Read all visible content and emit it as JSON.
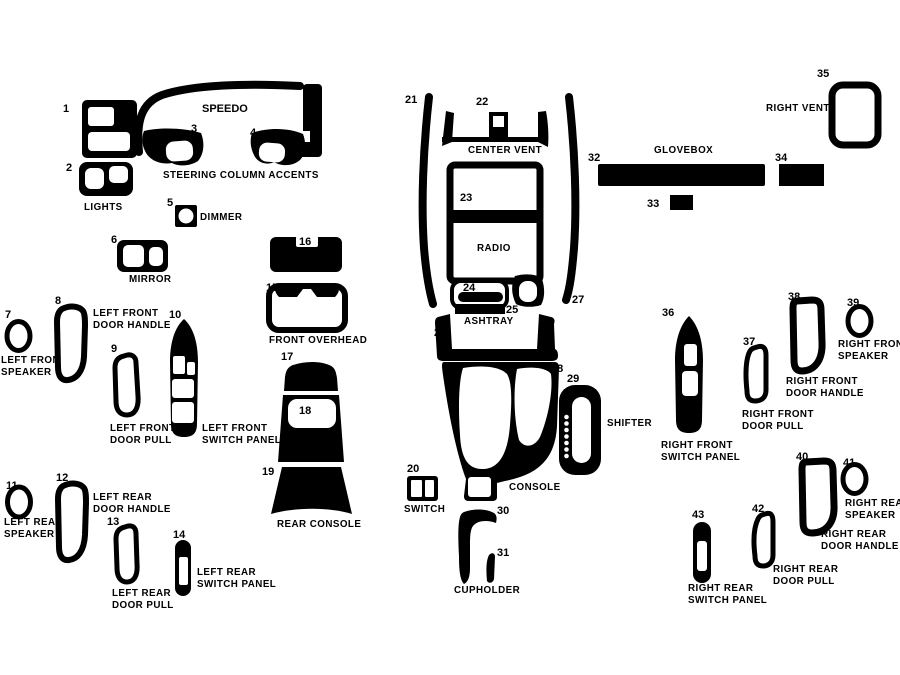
{
  "diagram": {
    "description": "vehicle dash trim kit parts diagram",
    "bg": "#ffffff",
    "ink": "#000000",
    "nums": [
      "1",
      "2",
      "3",
      "4",
      "5",
      "6",
      "7",
      "8",
      "9",
      "10",
      "11",
      "12",
      "13",
      "14",
      "15",
      "16",
      "17",
      "18",
      "19",
      "20",
      "21",
      "22",
      "23",
      "24",
      "25",
      "26",
      "27",
      "28",
      "29",
      "30",
      "31",
      "32",
      "33",
      "34",
      "35",
      "36",
      "37",
      "38",
      "39",
      "40",
      "41",
      "42",
      "43"
    ],
    "labels": {
      "speedo": "SPEEDO",
      "steering_column_accents": "STEERING COLUMN ACCENTS",
      "lights": "LIGHTS",
      "dimmer": "DIMMER",
      "mirror": "MIRROR",
      "front_overhead": "FRONT OVERHEAD",
      "center_vent": "CENTER VENT",
      "radio": "RADIO",
      "ashtray": "ASHTRAY",
      "glovebox": "GLOVEBOX",
      "right_vent": "RIGHT VENT",
      "rear_console": "REAR CONSOLE",
      "switch": "SWITCH",
      "console": "CONSOLE",
      "shifter": "SHIFTER",
      "cupholder": "CUPHOLDER",
      "left_front_speaker": [
        "LEFT FRONT",
        "SPEAKER"
      ],
      "left_front_door_handle": [
        "LEFT FRONT",
        "DOOR HANDLE"
      ],
      "left_front_door_pull": [
        "LEFT FRONT",
        "DOOR PULL"
      ],
      "left_front_switch_panel": [
        "LEFT FRONT",
        "SWITCH PANEL"
      ],
      "left_rear_speaker": [
        "LEFT REAR",
        "SPEAKER"
      ],
      "left_rear_door_handle": [
        "LEFT REAR",
        "DOOR HANDLE"
      ],
      "left_rear_door_pull": [
        "LEFT REAR",
        "DOOR PULL"
      ],
      "left_rear_switch_panel": [
        "LEFT REAR",
        "SWITCH PANEL"
      ],
      "right_front_speaker": [
        "RIGHT FRONT",
        "SPEAKER"
      ],
      "right_front_door_handle": [
        "RIGHT FRONT",
        "DOOR HANDLE"
      ],
      "right_front_door_pull": [
        "RIGHT FRONT",
        "DOOR PULL"
      ],
      "right_front_switch_panel": [
        "RIGHT FRONT",
        "SWITCH PANEL"
      ],
      "right_rear_speaker": [
        "RIGHT REAR",
        "SPEAKER"
      ],
      "right_rear_door_handle": [
        "RIGHT REAR",
        "DOOR HANDLE"
      ],
      "right_rear_door_pull": [
        "RIGHT REAR",
        "DOOR PULL"
      ],
      "right_rear_switch_panel": [
        "RIGHT REAR",
        "SWITCH PANEL"
      ]
    }
  }
}
